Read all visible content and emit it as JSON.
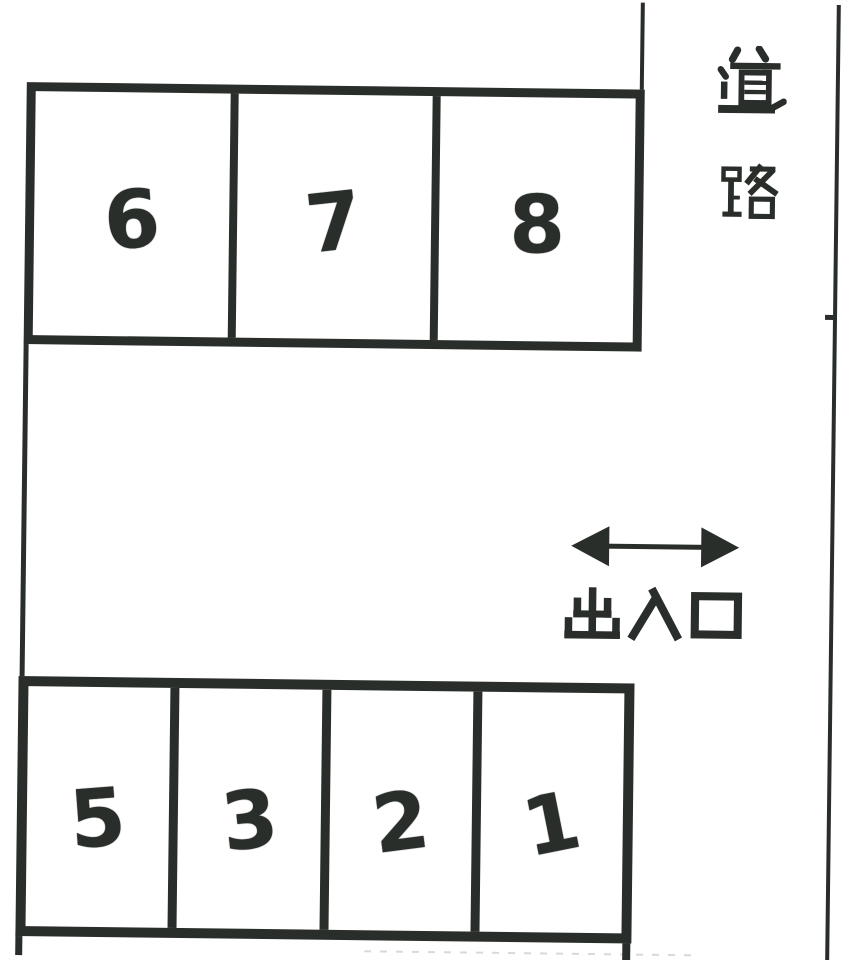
{
  "diagram": {
    "background_color": "#ffffff",
    "ink_color": "#2a2e2b"
  },
  "parking": {
    "top_row": {
      "spaces": [
        {
          "number": "6"
        },
        {
          "number": "7"
        },
        {
          "number": "8"
        }
      ]
    },
    "bottom_row": {
      "spaces": [
        {
          "number": "5"
        },
        {
          "number": "3"
        },
        {
          "number": "2"
        },
        {
          "number": "1"
        }
      ]
    }
  },
  "road": {
    "label": "道路",
    "char_top": "道",
    "char_bottom": "路"
  },
  "entrance": {
    "label": "出入口",
    "char_1": "出",
    "char_2": "入",
    "char_3": "口",
    "arrow": "double-headed-horizontal"
  }
}
